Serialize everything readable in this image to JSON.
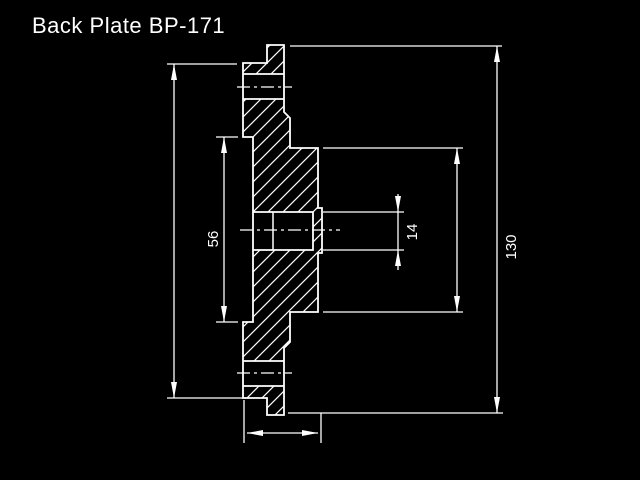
{
  "header": {
    "title": "Back Plate BP-171"
  },
  "drawing": {
    "type": "cad-section-view",
    "part_name": "Back Plate",
    "part_number": "BP-171",
    "colors": {
      "background": "#000000",
      "line": "#ffffff"
    },
    "dimensions": {
      "recess_diameter": "56",
      "bore_diameter": "14",
      "outer_diameter": "130"
    }
  }
}
